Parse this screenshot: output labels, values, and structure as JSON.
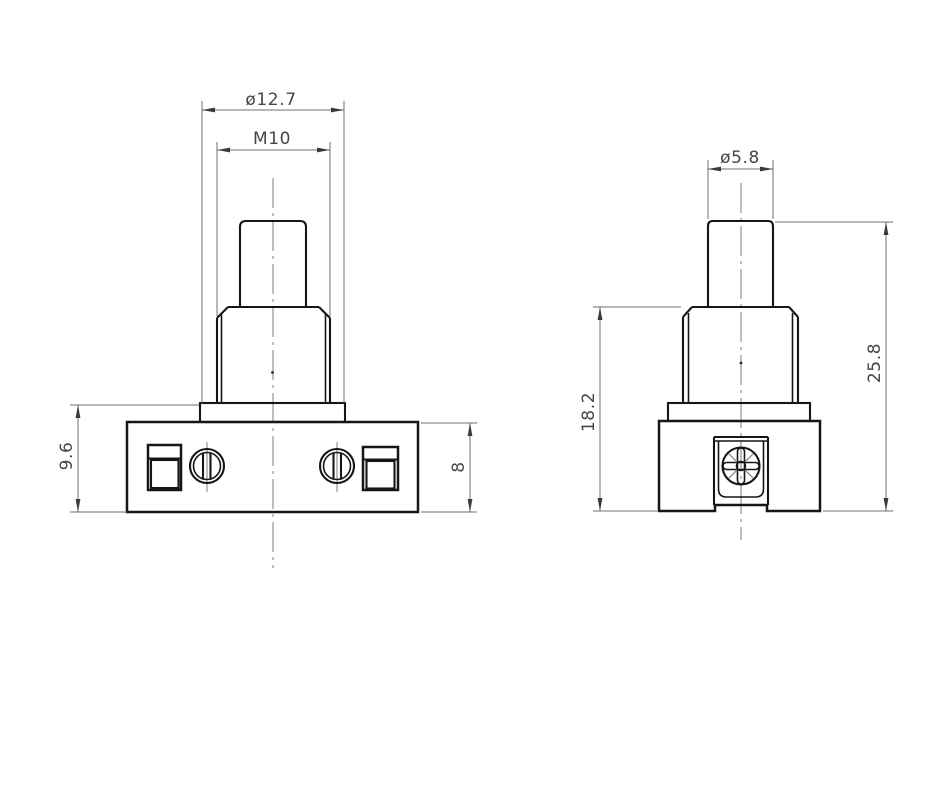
{
  "drawing": {
    "colors": {
      "background": "#ffffff",
      "line_color": "#161616",
      "dim_color": "#6f6f6f",
      "text_color": "#464646",
      "centerline_color": "#7d7d7d",
      "arrow_color": "#3a3a3a"
    },
    "views": {
      "front": {
        "dims": {
          "collar_diameter": "ø12.7",
          "thread": "M10",
          "flange_height": "9.6",
          "base_height": "8"
        }
      },
      "side": {
        "dims": {
          "plunger_diameter": "ø5.8",
          "body_height": "18.2",
          "overall_height": "25.8"
        }
      }
    }
  }
}
